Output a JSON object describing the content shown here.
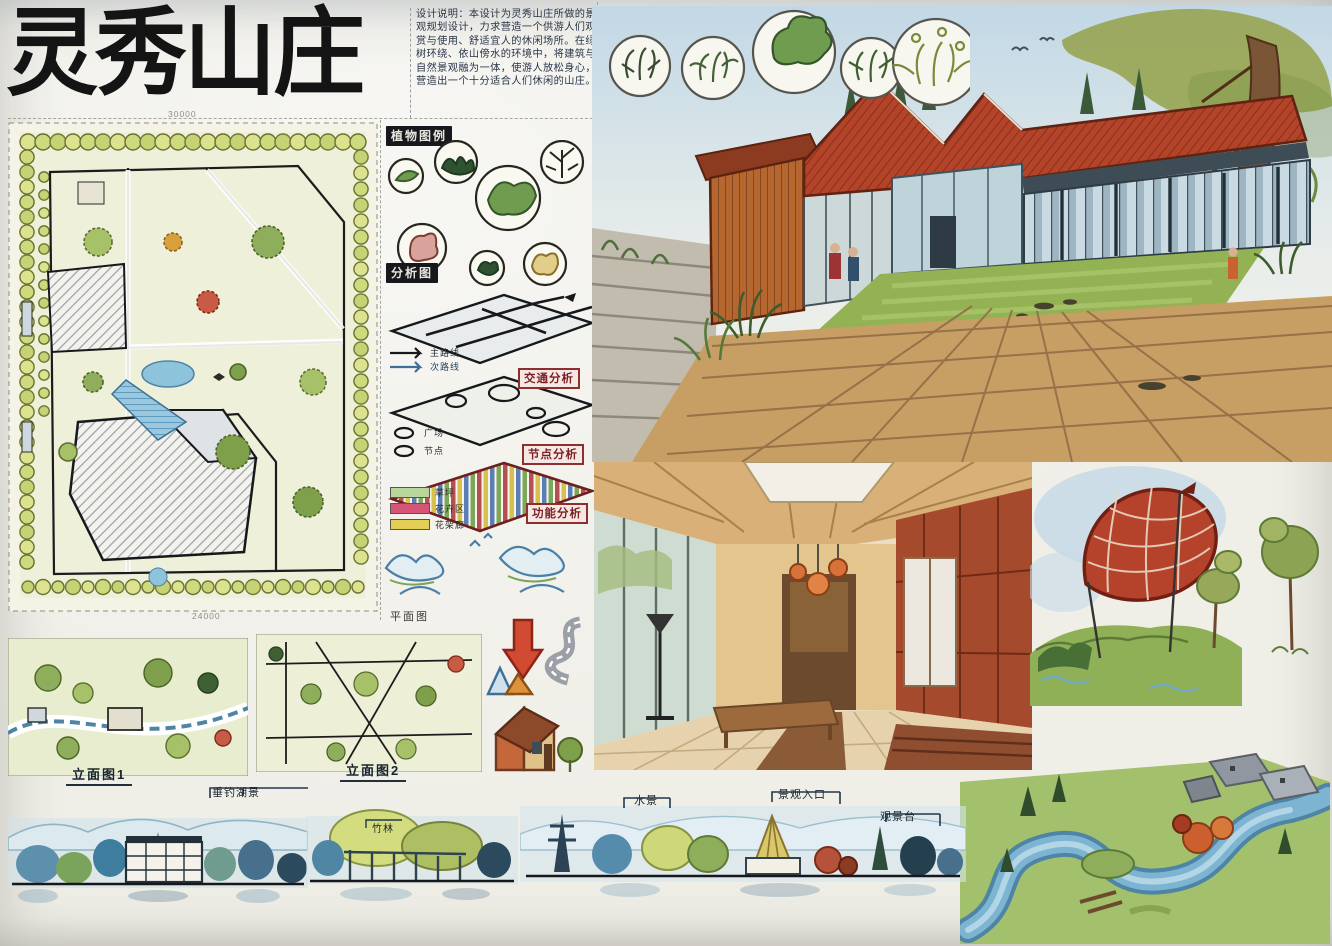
{
  "board": {
    "title": "灵秀山庄"
  },
  "design_notes": {
    "text": "设计说明：本设计为灵秀山庄所做的景观规划设计，力求营造一个供游人们观赏与使用、舒适宜人的休闲场所。在绿树环绕、依山傍水的环境中，将建筑与自然景观融为一体，使游人放松身心，营造出一个十分适合人们休闲的山庄。"
  },
  "master_plan": {
    "dim_top": "30000",
    "dim_bottom": "24000"
  },
  "plant_legend": {
    "label": "植物图例"
  },
  "analysis": {
    "label": "分析图",
    "plates": [
      {
        "label": "交通分析"
      },
      {
        "label": "节点分析"
      },
      {
        "label": "功能分析"
      }
    ],
    "route_legend": [
      "主路线",
      "次路线"
    ],
    "node_legend": [
      "广场",
      "节点"
    ],
    "zone_legend": [
      {
        "label": "草坪",
        "color": "#b9d69b"
      },
      {
        "label": "花卉区",
        "color": "#d65577"
      },
      {
        "label": "花架廊",
        "color": "#e3cf55"
      }
    ]
  },
  "plans": {
    "label": "平面图"
  },
  "elevations": {
    "one": {
      "title": "立面图1",
      "callout": "垂钓湖景"
    },
    "two": {
      "title": "立面图2",
      "callout": "竹林"
    },
    "three": {
      "callouts": [
        "水景",
        "景观入口",
        "观景台"
      ]
    }
  },
  "palette": {
    "roof_red": "#b34329",
    "wood": "#c79e63",
    "foliage": "#8fae5c",
    "tree_ring": "#dce28e",
    "water": "#7db4d2",
    "ink": "#17181c",
    "label_red": "#8d2f2f"
  }
}
